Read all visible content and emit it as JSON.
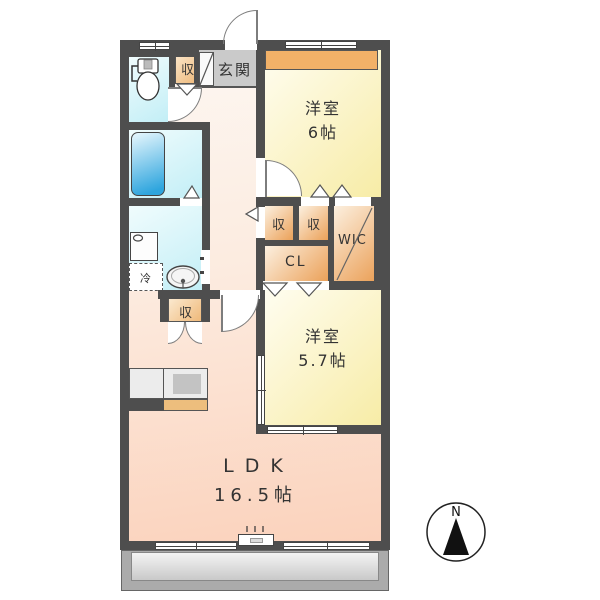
{
  "plan": {
    "rooms": {
      "entrance": {
        "label": "玄関"
      },
      "western_room_6": {
        "name": "洋室",
        "size": "6帖"
      },
      "western_room_5_7": {
        "name": "洋室",
        "size": "5.7帖"
      },
      "ldk": {
        "name": "LDK",
        "size": "16.5帖"
      },
      "wic": {
        "label": "WIC"
      },
      "closet": {
        "label": "CL"
      },
      "storage": {
        "label": "収"
      },
      "refrigerator": {
        "label": "冷"
      }
    },
    "compass": {
      "north": "N"
    }
  },
  "colors": {
    "wall": "#4e4e4e",
    "line": "#7d7d7d",
    "winline": "#444444",
    "text": "#333333",
    "yellow_a": "#fffdf0",
    "yellow_b": "#f7eca6",
    "band": "#f2b168",
    "orange_a": "#fcf0e0",
    "orange_b": "#eba159",
    "peach_a": "#fdf7f2",
    "peach_b": "#fbd2bc",
    "cyan_a": "#f0fcfd",
    "cyan_b": "#c2eef6",
    "tub_a": "#e8f7fd",
    "tub_b": "#2ea5de",
    "genkan": "#cacaca",
    "kitchen_band": "#edbe7d",
    "balcony_frame": "#ababab",
    "balcony_a": "#f4f4f4",
    "balcony_b": "#c9c9c9",
    "gray_fixture": "#c3c3c3"
  }
}
